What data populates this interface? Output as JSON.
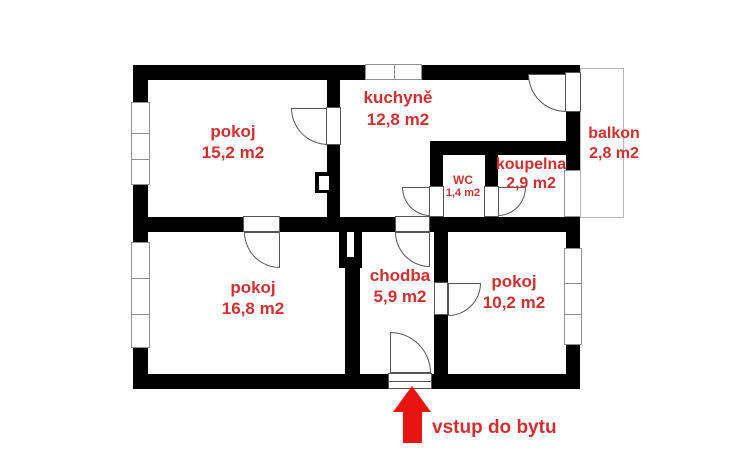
{
  "palette": {
    "wall": "#000000",
    "label_red": "#cf3131",
    "arrow_red": "#e81410",
    "window_gray": "#8f8f8f",
    "balcony_gray": "#b8b8b8",
    "door_gray": "#555555"
  },
  "rooms": [
    {
      "id": "pokoj-1",
      "name": "pokoj",
      "area": "15,2 m2"
    },
    {
      "id": "kuchyne",
      "name": "kuchyně",
      "area": "12,8 m2"
    },
    {
      "id": "balkon",
      "name": "balkon",
      "area": "2,8 m2"
    },
    {
      "id": "koupelna",
      "name": "koupelna",
      "area": "2,9 m2"
    },
    {
      "id": "wc",
      "name": "WC",
      "area": "1,4 m2"
    },
    {
      "id": "pokoj-2",
      "name": "pokoj",
      "area": "16,8 m2"
    },
    {
      "id": "chodba",
      "name": "chodba",
      "area": "5,9 m2"
    },
    {
      "id": "pokoj-3",
      "name": "pokoj",
      "area": "10,2 m2"
    }
  ],
  "entrance": {
    "label": "vstup do bytu"
  }
}
